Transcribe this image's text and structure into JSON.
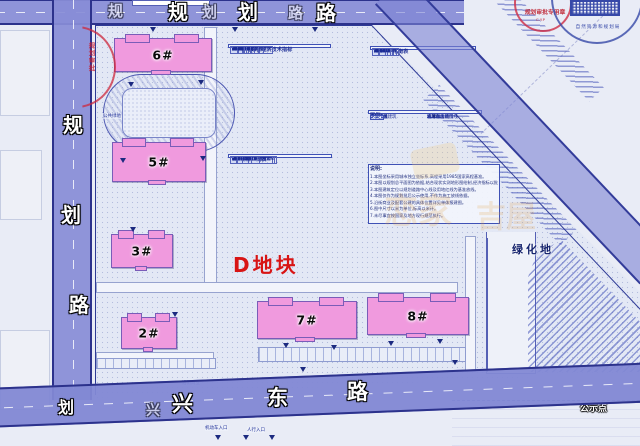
{
  "plot_label": "D地块",
  "green_area_label": "绿化地",
  "notice_label": "公示点",
  "roads": {
    "top": "规划路",
    "left": "规划路",
    "bottom": "兴东路",
    "junction_char": "划",
    "bottom_faint_char": "兴"
  },
  "buildings": [
    {
      "label": "6#"
    },
    {
      "label": "5#"
    },
    {
      "label": "3#"
    },
    {
      "label": "2#"
    },
    {
      "label": "7#"
    },
    {
      "label": "8#"
    }
  ],
  "tables": {
    "main": {
      "title": "居住用地综合经济技术指标",
      "header": [
        "项目",
        "数值",
        "单位",
        "备注"
      ],
      "widths": [
        36,
        26,
        12,
        26
      ],
      "rows": [
        [
          "规划用地",
          "9.8043",
          "ha",
          ""
        ],
        [
          "总建筑面积",
          "44936.43",
          "㎡",
          ""
        ],
        [
          "地上建筑面积",
          "35766.37",
          "㎡",
          ""
        ],
        [
          "住宅建筑面积",
          "6482.12",
          "㎡",
          ""
        ],
        [
          "配套建筑面积",
          "3582.27",
          "㎡",
          ""
        ],
        [
          "地下建筑面积",
          "7768.48",
          "㎡",
          ""
        ],
        [
          "计容建筑面积",
          "82002.48",
          "㎡",
          "含配套公建面积"
        ],
        [
          "不计容建筑面积",
          "20034.11",
          "㎡",
          "含地下车库设备用房"
        ],
        [
          "机动车位",
          "1703",
          "辆",
          "(含地下车位)"
        ],
        [
          "绿地率",
          "24%",
          "",
          ""
        ],
        [
          "总人数",
          "1645",
          "人",
          "3.2人/户"
        ]
      ]
    },
    "facilities": {
      "title": "公共配套一览表",
      "header": [
        "序号",
        "项目",
        "单位",
        "地上建筑面积",
        "备注"
      ],
      "widths": [
        7,
        30,
        9,
        20,
        34
      ],
      "rows": [
        [
          "1",
          "社区办公及服务用房",
          "㎡",
          "465.12",
          "与物业管理用房合设"
        ],
        [
          "2",
          "物业管理用房",
          "㎡",
          "1682.70",
          "不小于总建筑面积7‰"
        ],
        [
          "3",
          "配套商业设施",
          "㎡",
          "1287.38",
          "不小于总建筑面积3%"
        ],
        [
          "",
          "合计",
          "㎡",
          "2846.88",
          ""
        ]
      ]
    },
    "balance": {
      "title": "规划用地平衡表",
      "header": [
        "编号",
        "项目",
        "单位",
        "用地面积",
        "所占比例"
      ],
      "widths": [
        9,
        28,
        10,
        29,
        24
      ],
      "rows": [
        [
          "1",
          "住宅用地",
          "㎡",
          "76756.88",
          "73.76"
        ],
        [
          "2",
          "公建用地",
          "㎡",
          "2827.84",
          "2.88"
        ],
        [
          "3",
          "道路用地",
          "㎡",
          "23478.98",
          "18.98"
        ],
        [
          "4",
          "绿化用地",
          "㎡",
          "1232.77",
          "5.38"
        ],
        [
          "",
          "规划总用地",
          "㎡",
          "104976.47",
          "100.00"
        ]
      ]
    }
  },
  "legend": {
    "title": "图例",
    "area_items": [
      {
        "type": "empty",
        "label": "规划建筑"
      },
      {
        "type": "hatch",
        "label": "周边现状建筑"
      },
      {
        "type": "dots",
        "label": "公共绿地"
      },
      {
        "type": "dashdot",
        "label": "用地红线"
      }
    ],
    "line_items": [
      {
        "type": "dash",
        "label": "地下车库范围线"
      },
      {
        "type": "solid",
        "label": "道路中心线"
      },
      {
        "type": "tri",
        "label": "机动车出入口"
      },
      {
        "type": "tri-open",
        "label": "人行出入口"
      }
    ]
  },
  "notes": {
    "title": "说明:",
    "lines": [
      "1.本图坐标采用城市独立坐标系,高程采用1985国家高程基准。",
      "2.本图以规划总平面图为依据,结合现状实测地形图绘制,经济指标以批复文件为准。",
      "3.本图建筑定位以规划道路中心线及用地红线为基准放线。",
      "4.本图仅作为规划批后公示使用,不作为施工放线依据。",
      "5.沿街商业及配套公建的具体位置详见单体报建图。",
      "6.图中尺寸以米为单位,标高以米计。",
      "7.未尽事宜按国家及地方现行规范执行。"
    ]
  },
  "stamps": {
    "red_text": "规划审批专用章",
    "red_sub": "C.Y.P",
    "blue_ring": "自然资源和规划局",
    "left_red": "规划审批"
  },
  "annotations": [
    "沿街商业",
    "机动车入口",
    "人行入口",
    "公共绿地"
  ],
  "watermark": {
    "texts": [
      "恋家",
      "吉屋"
    ]
  },
  "colors": {
    "road": "#8f94da",
    "building": "#f09ade",
    "plot_red": "#d81414",
    "line_blue": "#2e3a96",
    "paper": "#e9ecf6"
  }
}
